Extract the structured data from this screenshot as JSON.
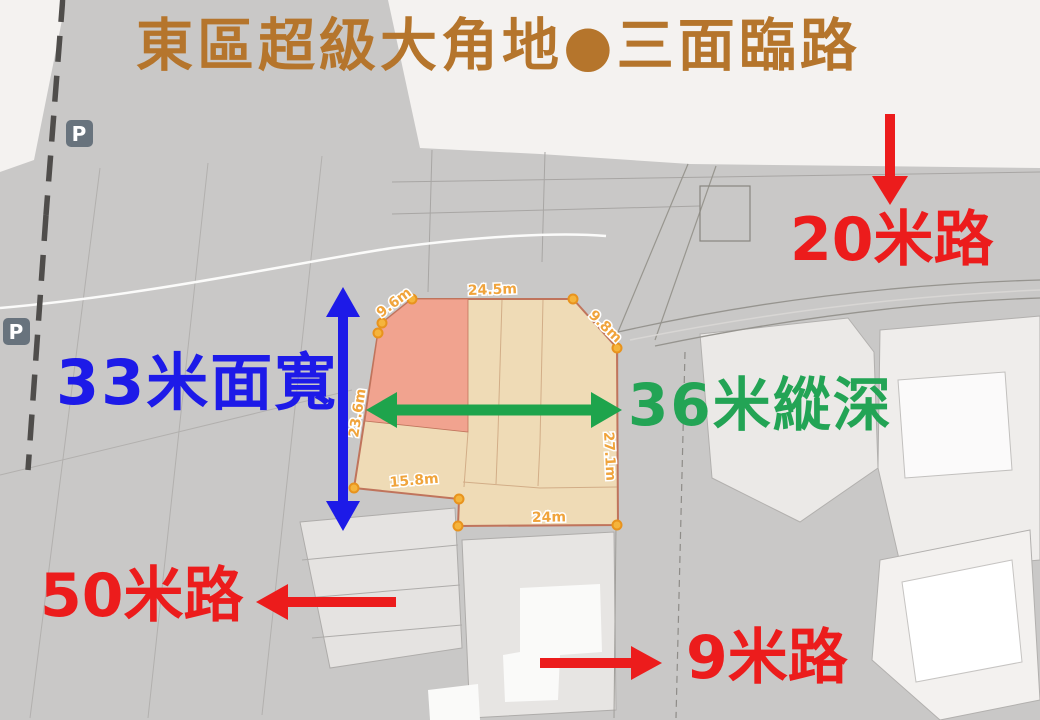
{
  "title": {
    "text": "東區超級大角地●三面臨路",
    "color": "#b5752c"
  },
  "annotations": {
    "frontage": {
      "text": "33米面寬",
      "color": "#1d1ae8"
    },
    "depth": {
      "text": "36米縱深",
      "color": "#23a455"
    },
    "road_top": {
      "text": "20米路",
      "color": "#ec1c1c"
    },
    "road_left": {
      "text": "50米路",
      "color": "#ec1c1c"
    },
    "road_bottom": {
      "text": "9米路",
      "color": "#ec1c1c"
    }
  },
  "parcel": {
    "highlight_fill": "#f2dcb4",
    "sub_lot_fill": "#f0a08d",
    "outline_color": "#c0745c",
    "vertex_color": "#f5b43c",
    "measure_color": "#f0a43c",
    "measurements": [
      {
        "edge": "top",
        "label": "24.5m"
      },
      {
        "edge": "top-left-diagonal",
        "label": "9.6m"
      },
      {
        "edge": "top-right-diagonal",
        "label": "9.8m"
      },
      {
        "edge": "left",
        "label": "23.6m"
      },
      {
        "edge": "right",
        "label": "27.1m"
      },
      {
        "edge": "bottom-inner",
        "label": "15.8m"
      },
      {
        "edge": "bottom",
        "label": "24m"
      }
    ]
  },
  "map": {
    "parking_label": "P"
  }
}
